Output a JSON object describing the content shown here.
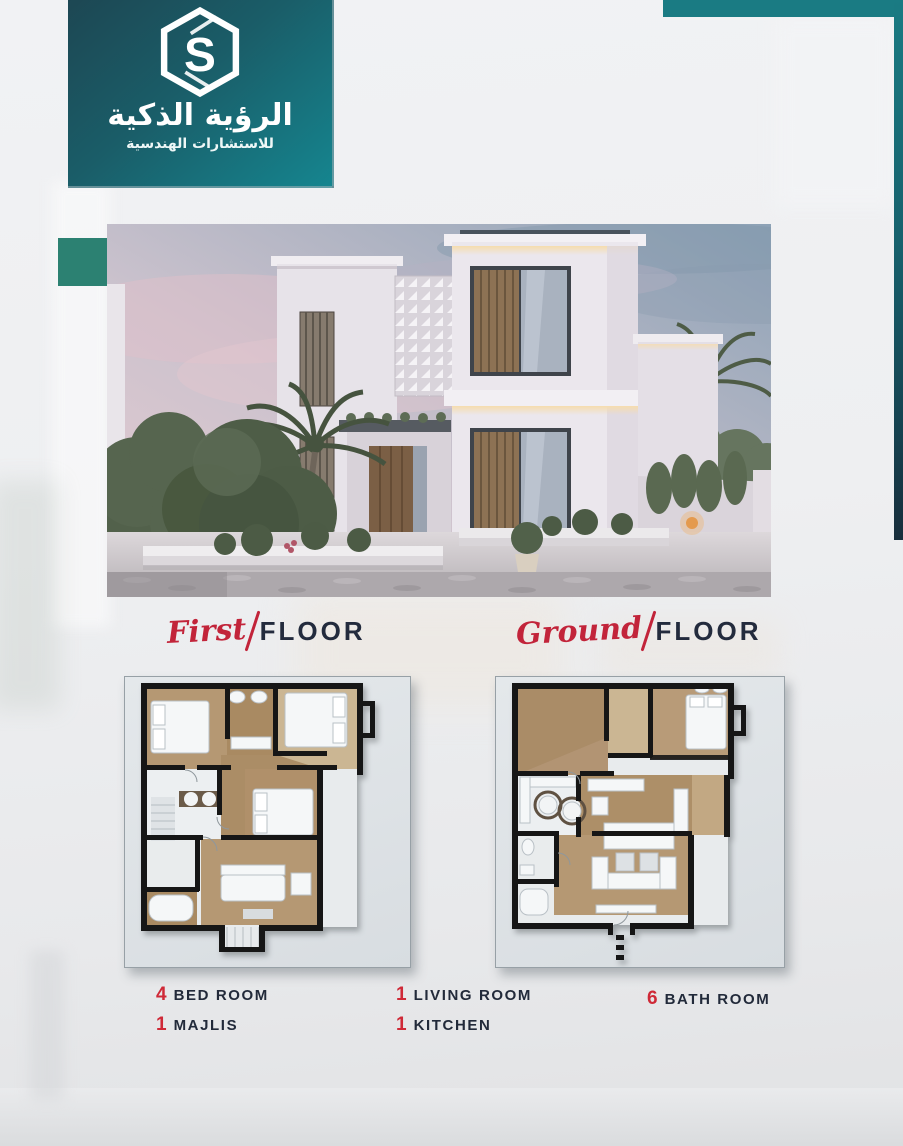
{
  "colors": {
    "teal_bar": "#1a7b83",
    "teal_bar_dark_end": "#182e3c",
    "badge_teal_top": "#1d4753",
    "badge_teal_bottom": "#15858f",
    "accent_green_square": "#2c8172",
    "heading_navy": "#232b3d",
    "accent_red": "#cf2937",
    "script_red": "#c2243a",
    "plan_card_bg": "#dde1e4"
  },
  "logo": {
    "icon": "hexagon-s-logo",
    "monogram": "S",
    "title_ar": "الرؤية الذكية",
    "subtitle_ar": "للاستشارات الهندسية"
  },
  "hero": {
    "description": "dusk-photo-of-modern-two-storey-white-villa-with-palms"
  },
  "sections": {
    "first": {
      "script": "First",
      "caps": "FLOOR"
    },
    "ground": {
      "script": "Ground",
      "caps": "FLOOR"
    }
  },
  "features": [
    {
      "count": "4",
      "label": "BED ROOM"
    },
    {
      "count": "1",
      "label": "MAJLIS"
    },
    {
      "count": "1",
      "label": "LIVING ROOM"
    },
    {
      "count": "1",
      "label": "KITCHEN"
    },
    {
      "count": "6",
      "label": "BATH ROOM"
    }
  ]
}
